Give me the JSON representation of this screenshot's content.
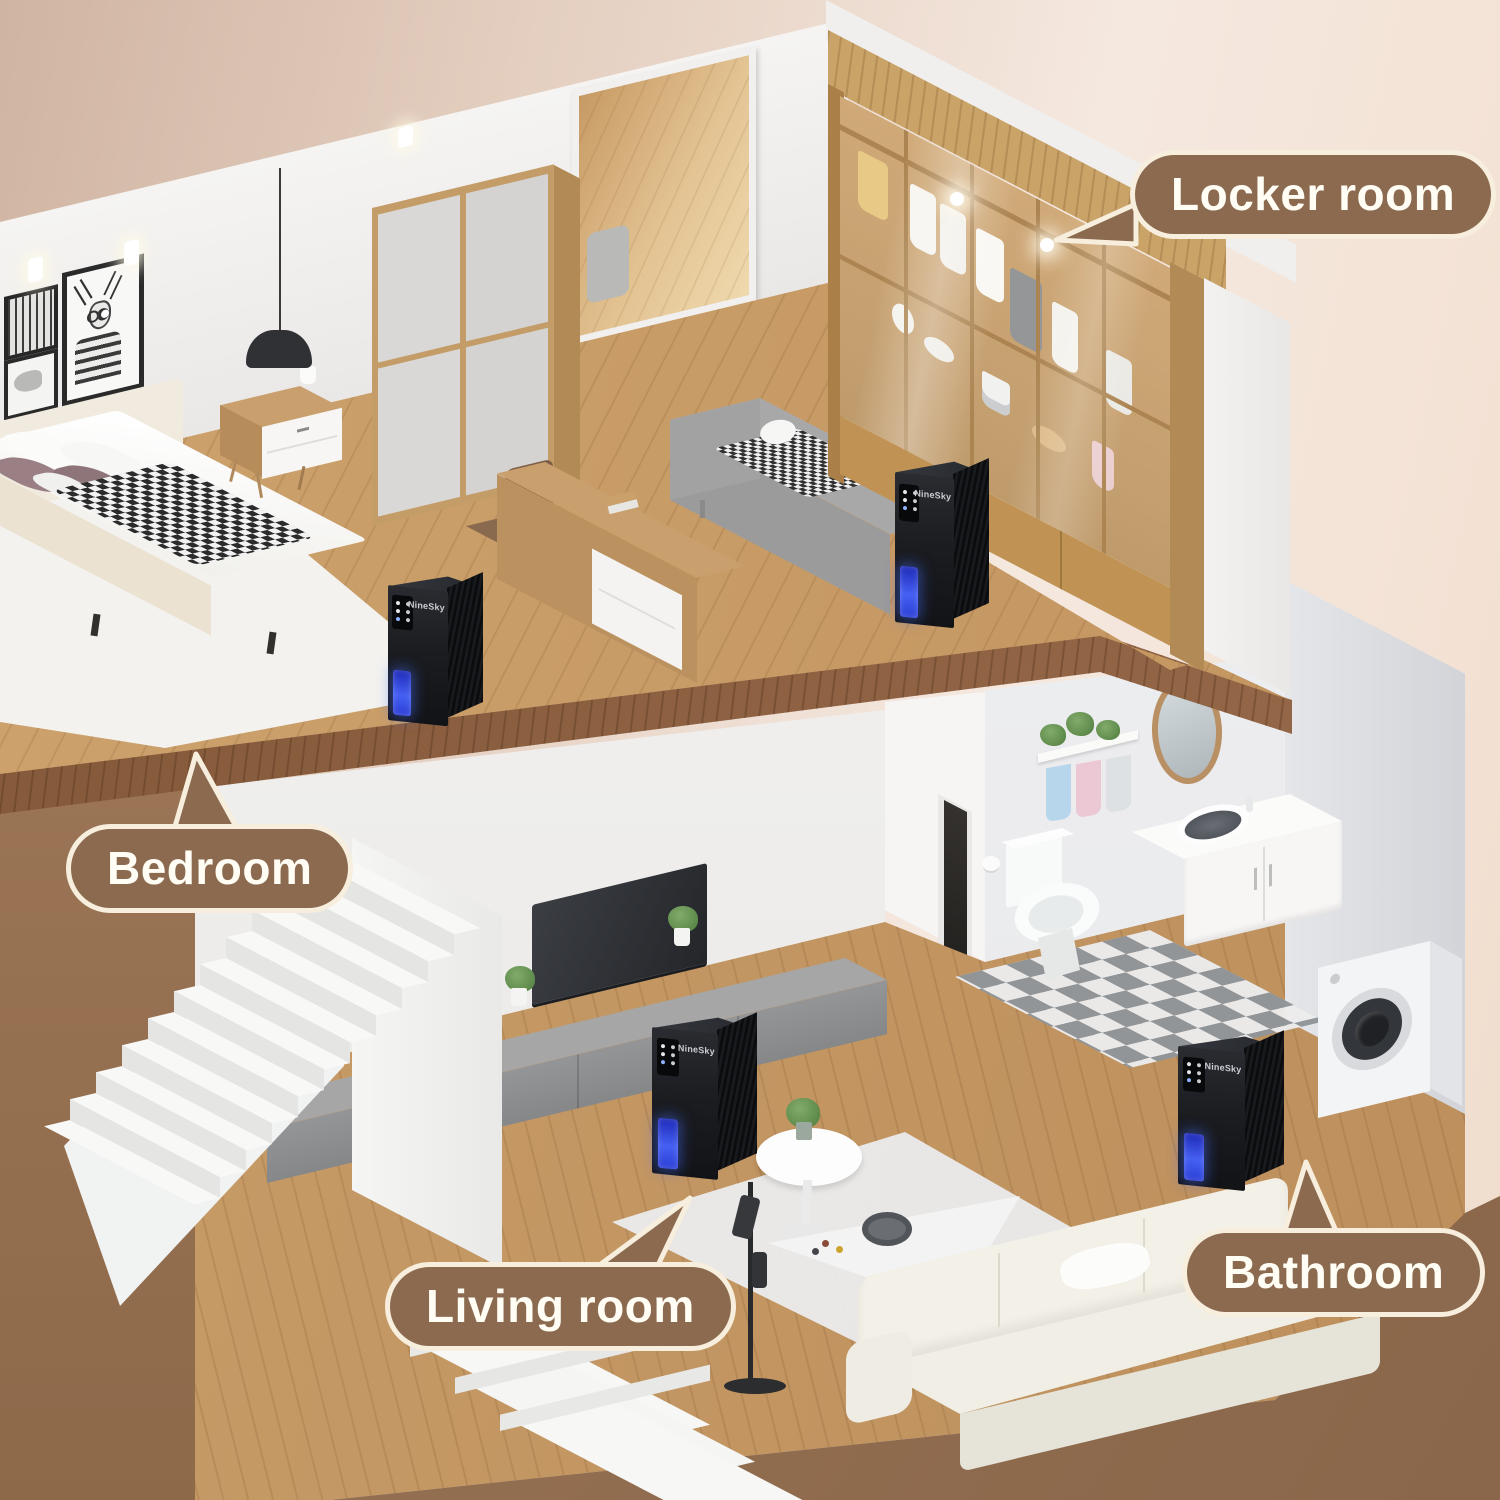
{
  "scene": {
    "kind": "isometric-home-cutaway-product-illustration",
    "palette": {
      "background_left": "#d0b4a2",
      "background_right": "#f5e8df",
      "ground_brown": "#8d694a",
      "wood_floor": "#c79b66",
      "closet_wood": "#c09355",
      "wall_white": "#f4f3f2"
    }
  },
  "callouts": {
    "locker_room": {
      "label": "Locker room"
    },
    "bedroom": {
      "label": "Bedroom"
    },
    "living_room": {
      "label": "Living room"
    },
    "bathroom": {
      "label": "Bathroom"
    }
  },
  "callout_style": {
    "fill": "#8b6a50",
    "outline": "#f7eedd",
    "text_color": "#fffdf4"
  },
  "device": {
    "brand": "NineSky",
    "body_color": "#1b1d21",
    "water_window_color": "#3a50e8",
    "count": 4
  }
}
